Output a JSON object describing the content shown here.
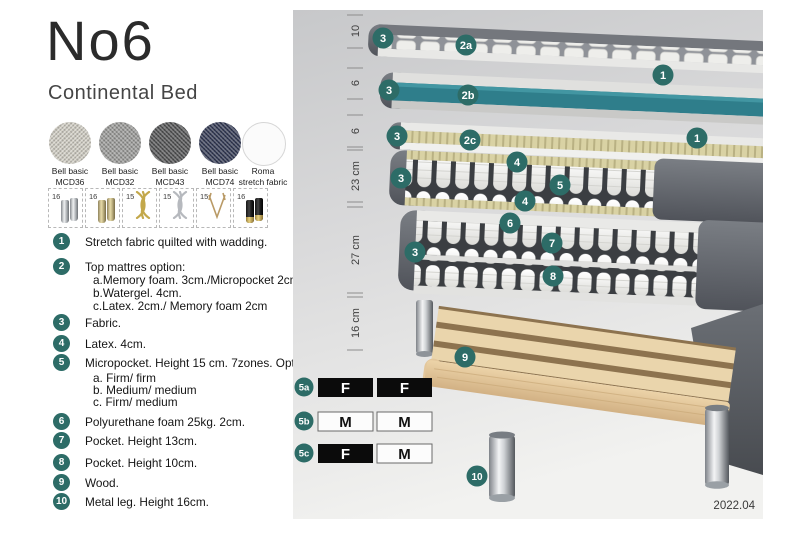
{
  "header": {
    "title": "No6",
    "subtitle": "Continental Bed"
  },
  "swatches": [
    {
      "line1": "Bell basic",
      "line2": "MCD36",
      "color": "#d3d0c6"
    },
    {
      "line1": "Bell basic",
      "line2": "MCD32",
      "color": "#9d9d9b"
    },
    {
      "line1": "Bell basic",
      "line2": "MCD43",
      "color": "#545556"
    },
    {
      "line1": "Bell basic",
      "line2": "MCD74",
      "color": "#333a55"
    },
    {
      "line1": "Roma",
      "line2": "stretch fabric",
      "color": "#fbfbfb"
    }
  ],
  "leg_options": [
    {
      "size": "16",
      "type": "cylinder-silver"
    },
    {
      "size": "16",
      "type": "cylinder-gold"
    },
    {
      "size": "15",
      "type": "twist-gold"
    },
    {
      "size": "15",
      "type": "twist-silver"
    },
    {
      "size": "15",
      "type": "hairpin"
    },
    {
      "size": "16",
      "type": "black-gold"
    }
  ],
  "legend": [
    {
      "num": "1",
      "text": "Stretch fabric quilted with wadding.",
      "subs": []
    },
    {
      "num": "2",
      "text": "Top mattres option:",
      "subs": [
        "a.Memory foam. 3cm./Micropocket 2cm",
        "b.Watergel. 4cm.",
        "c.Latex. 2cm./ Memory foam 2cm"
      ]
    },
    {
      "num": "3",
      "text": "Fabric.",
      "subs": []
    },
    {
      "num": "4",
      "text": "Latex. 4cm.",
      "subs": []
    },
    {
      "num": "5",
      "text": "Micropocket. Height 15 cm. 7zones. Option:",
      "subs": [
        "a. Firm/ firm",
        "b. Medium/ medium",
        "c. Firm/ medium"
      ]
    },
    {
      "num": "6",
      "text": "Polyurethane foam 25kg. 2cm.",
      "subs": []
    },
    {
      "num": "7",
      "text": "Pocket. Height 13cm.",
      "subs": []
    },
    {
      "num": "8",
      "text": "Pocket. Height 10cm.",
      "subs": []
    },
    {
      "num": "9",
      "text": "Wood.",
      "subs": []
    },
    {
      "num": "10",
      "text": "Metal leg. Height 16cm.",
      "subs": []
    }
  ],
  "diagram": {
    "measurements": [
      {
        "label": "10"
      },
      {
        "label": "6"
      },
      {
        "label": "6"
      },
      {
        "label": "23 cm"
      },
      {
        "label": "27 cm"
      },
      {
        "label": "16 cm"
      }
    ],
    "callouts": [
      {
        "label": "3"
      },
      {
        "label": "2a"
      },
      {
        "label": "1"
      },
      {
        "label": "3"
      },
      {
        "label": "2b"
      },
      {
        "label": "3"
      },
      {
        "label": "2c"
      },
      {
        "label": "1"
      },
      {
        "label": "3"
      },
      {
        "label": "4"
      },
      {
        "label": "5"
      },
      {
        "label": "4"
      },
      {
        "label": "6"
      },
      {
        "label": "7"
      },
      {
        "label": "3"
      },
      {
        "label": "8"
      },
      {
        "label": "9"
      },
      {
        "label": "10"
      }
    ],
    "firmness": [
      {
        "label": "5a",
        "left": "F",
        "right": "F"
      },
      {
        "label": "5b",
        "left": "M",
        "right": "M"
      },
      {
        "label": "5c",
        "left": "F",
        "right": "M"
      }
    ],
    "version": "2022.04"
  },
  "colors": {
    "accent": "#2d6c67",
    "watergel": "#2f7e8b"
  }
}
